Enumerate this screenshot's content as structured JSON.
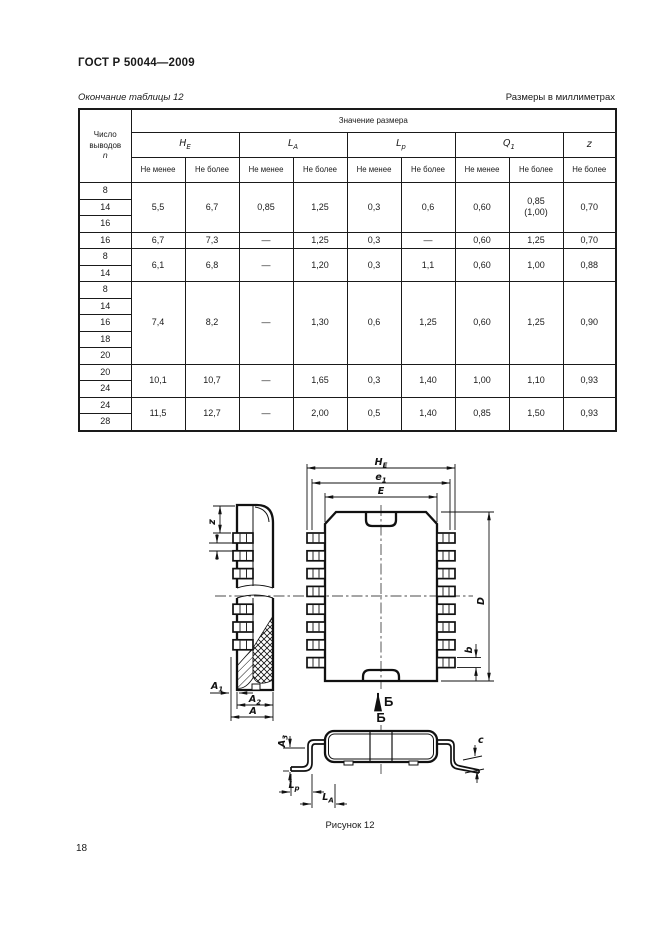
{
  "page": {
    "standard": "ГОСТ Р 50044—2009",
    "table_caption": "Окончание таблицы 12",
    "units_note": "Размеры в миллиметрах",
    "figure_caption": "Рисунок 12",
    "page_number": "18"
  },
  "table": {
    "col_pins_title": "Число выводов",
    "col_pins_symbol": "n",
    "value_header": "Значение размера",
    "min_label": "Не менее",
    "max_label": "Не более",
    "symbols": {
      "he": {
        "main": "H",
        "sub": "E"
      },
      "la": {
        "main": "L",
        "sub": "A"
      },
      "lp": {
        "main": "L",
        "sub": "p"
      },
      "q1": {
        "main": "Q",
        "sub": "1"
      },
      "z": {
        "main": "z",
        "sub": ""
      }
    },
    "groups": [
      {
        "pins": [
          "8",
          "14",
          "16"
        ],
        "values": [
          "5,5",
          "6,7",
          "0,85",
          "1,25",
          "0,3",
          "0,6",
          "0,60",
          "0,85\n(1,00)",
          "0,70"
        ]
      },
      {
        "pins": [
          "16"
        ],
        "values": [
          "6,7",
          "7,3",
          "—",
          "1,25",
          "0,3",
          "—",
          "0,60",
          "1,25",
          "0,70"
        ]
      },
      {
        "pins": [
          "8",
          "14"
        ],
        "values": [
          "6,1",
          "6,8",
          "—",
          "1,20",
          "0,3",
          "1,1",
          "0,60",
          "1,00",
          "0,88"
        ]
      },
      {
        "pins": [
          "8",
          "14",
          "16",
          "18",
          "20"
        ],
        "values": [
          "7,4",
          "8,2",
          "—",
          "1,30",
          "0,6",
          "1,25",
          "0,60",
          "1,25",
          "0,90"
        ]
      },
      {
        "pins": [
          "20",
          "24"
        ],
        "values": [
          "10,1",
          "10,7",
          "—",
          "1,65",
          "0,3",
          "1,40",
          "1,00",
          "1,10",
          "0,93"
        ]
      },
      {
        "pins": [
          "24",
          "28"
        ],
        "values": [
          "11,5",
          "12,7",
          "—",
          "2,00",
          "0,5",
          "1,40",
          "0,85",
          "1,50",
          "0,93"
        ]
      }
    ]
  },
  "figure": {
    "dims": {
      "he": {
        "main": "H",
        "sub": "E"
      },
      "e1": {
        "main": "e",
        "sub": "1"
      },
      "E": {
        "main": "E"
      },
      "D": {
        "main": "D"
      },
      "b": {
        "main": "b"
      },
      "z": {
        "main": "z"
      },
      "a1": {
        "main": "A",
        "sub": "1"
      },
      "a2": {
        "main": "A",
        "sub": "2"
      },
      "a": {
        "main": "A"
      },
      "a3": {
        "main": "A",
        "sub": "3"
      },
      "lp": {
        "main": "L",
        "sub": "p"
      },
      "la": {
        "main": "L",
        "sub": "A"
      },
      "c": {
        "main": "c"
      },
      "view": "Б"
    }
  }
}
